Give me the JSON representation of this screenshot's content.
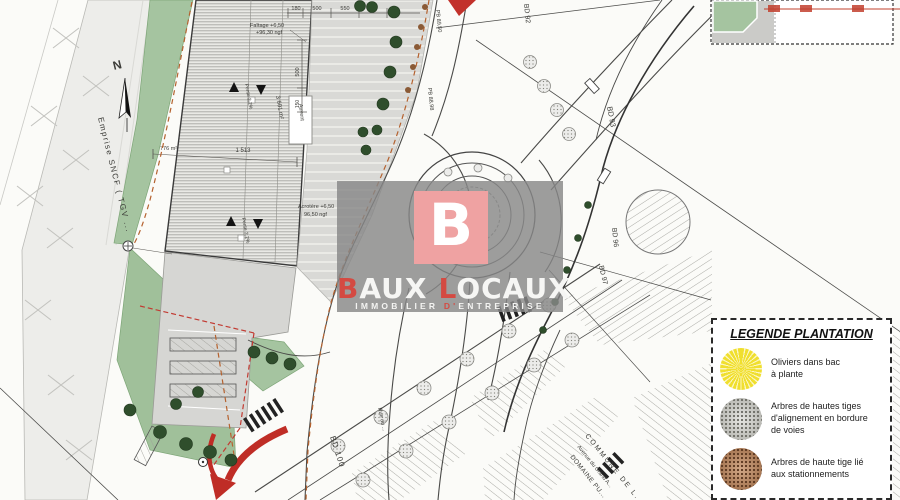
{
  "watermark": {
    "logo_letter": "B",
    "brand": {
      "part1_red": "B",
      "part1_rest": "AUX",
      "part2_red": "L",
      "part2_rest": "OCAUX"
    },
    "tagline": {
      "pre": "IMMOBILIER ",
      "red": "D'",
      "post": "ENTREPRISE"
    },
    "colors": {
      "square": "#EFA2A2",
      "accent": "#D44A42",
      "band": "#888888"
    }
  },
  "legend": {
    "title": "LEGENDE PLANTATION",
    "items": [
      {
        "symbol": "olivier-symbol",
        "color": "#F0DF2E",
        "line1": "Oliviers dans bac",
        "line2": "à plante",
        "line3": ""
      },
      {
        "symbol": "arbre-alignement-symbol",
        "color": "#A9A9A3",
        "line1": "Arbres de hautes tiges",
        "line2": "d'alignement  en bordure",
        "line3": "de voies"
      },
      {
        "symbol": "arbre-stationnement-symbol",
        "color": "#96643F",
        "line1": "Arbres de haute tige lié",
        "line2": "aux stationnements",
        "line3": ""
      }
    ]
  },
  "plan": {
    "north": "N",
    "sncf_label": "Emprise SNCF ( TGV ...",
    "building": {
      "ridge_line1": "Faîtage +6,50",
      "ridge_line2": "+96,30 ngf",
      "acrotere_line1": "Acrotère  +6,50",
      "acrotere_line2": "96,50 ngf",
      "slope": "Pente 2,2%",
      "area": "3 601 m²",
      "green_area": "776 m²",
      "canopy": "Auvent",
      "length": "1 513"
    },
    "dims": {
      "d180": "180",
      "d500a": "500",
      "d550": "550",
      "d500b": "500",
      "d500v": "500",
      "d150": "150"
    },
    "roads": {
      "bd92": "BD 92",
      "bd93": "BD 93",
      "bd96": "BD 96",
      "bd97": "BD 97",
      "bd100": "BD 100",
      "pb_high": "PB 89,50",
      "pb_low": "PB 88,98",
      "rue": "Rue du ...",
      "commune": "COMMUNE DE L...",
      "avenue": "Avenue du Grand A...",
      "domaine": "DOMAINE PU..."
    }
  }
}
